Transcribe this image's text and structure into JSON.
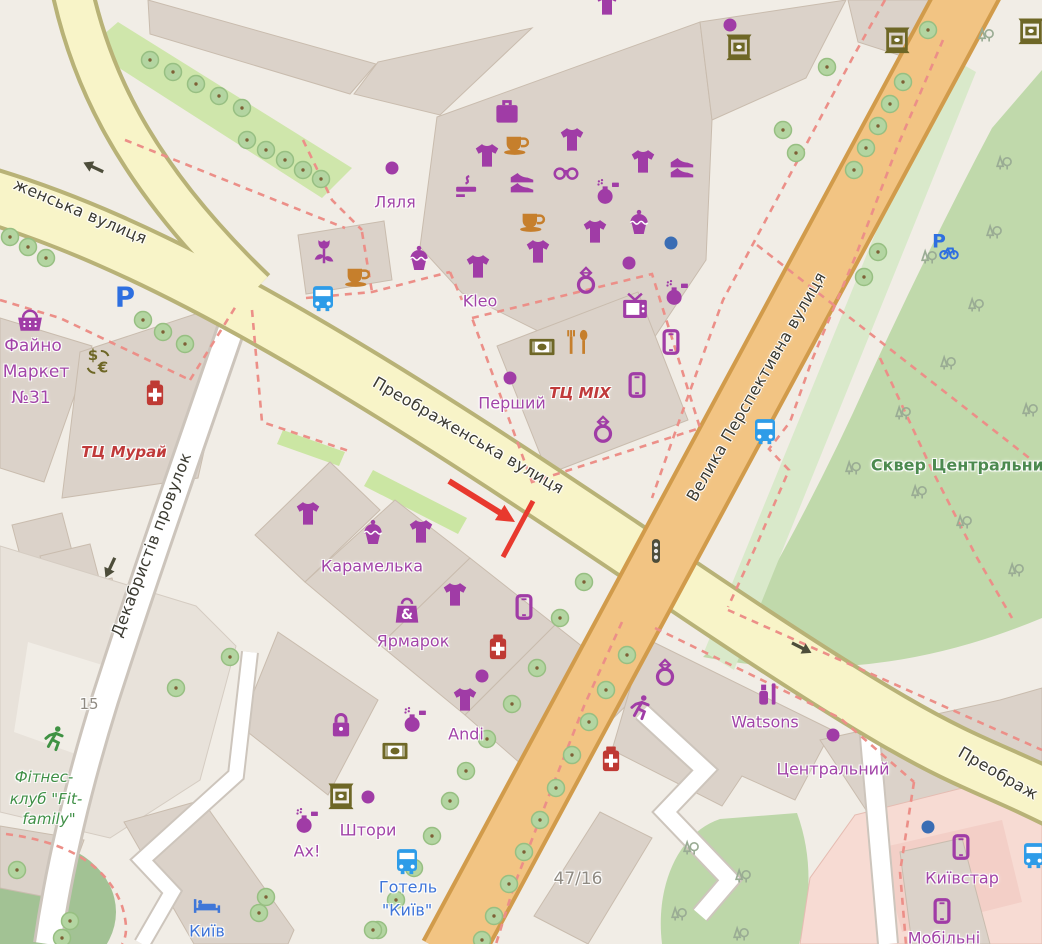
{
  "map": {
    "description": "OpenStreetMap style city map of Kropyvnytskyi area with red tutorial arrow annotation",
    "street_labels": [
      {
        "text": "женська вулиця",
        "x": 80,
        "y": 212,
        "rot": 23,
        "size": 16
      },
      {
        "text": "Преображенська вулиця",
        "x": 468,
        "y": 436,
        "rot": 30,
        "size": 16
      },
      {
        "text": "Велика Перспективна вулиця",
        "x": 757,
        "y": 387,
        "rot": -60,
        "size": 16
      },
      {
        "text": "Декабристів провулок",
        "x": 152,
        "y": 545,
        "rot": -69,
        "size": 16
      },
      {
        "text": "Преображ",
        "x": 998,
        "y": 774,
        "rot": 30,
        "size": 16
      }
    ],
    "place_labels": [
      {
        "text": "Ляля",
        "x": 395,
        "y": 203,
        "cls": "poi",
        "size": 16
      },
      {
        "text": "Kleo",
        "x": 480,
        "y": 302,
        "cls": "poi",
        "size": 16
      },
      {
        "text": "Перший",
        "x": 512,
        "y": 404,
        "cls": "poi",
        "size": 16
      },
      {
        "text": "ТЦ MIX",
        "x": 580,
        "y": 394,
        "cls": "mall",
        "size": 15
      },
      {
        "text": "Файно",
        "x": 33,
        "y": 347,
        "cls": "poi",
        "size": 17
      },
      {
        "text": "Маркет",
        "x": 36,
        "y": 373,
        "cls": "poi",
        "size": 17
      },
      {
        "text": "№31",
        "x": 31,
        "y": 399,
        "cls": "poi",
        "size": 17
      },
      {
        "text": "ТЦ Мурай",
        "x": 124,
        "y": 453,
        "cls": "mall",
        "size": 15
      },
      {
        "text": "Карамелька",
        "x": 372,
        "y": 567,
        "cls": "poi",
        "size": 16
      },
      {
        "text": "Ярмарок",
        "x": 413,
        "y": 642,
        "cls": "poi",
        "size": 16
      },
      {
        "text": "Andi",
        "x": 466,
        "y": 735,
        "cls": "poi",
        "size": 16
      },
      {
        "text": "Штори",
        "x": 368,
        "y": 831,
        "cls": "poi",
        "size": 16
      },
      {
        "text": "Ах!",
        "x": 307,
        "y": 852,
        "cls": "poi",
        "size": 16
      },
      {
        "text": "Watsons",
        "x": 765,
        "y": 723,
        "cls": "poi",
        "size": 16
      },
      {
        "text": "Центральний",
        "x": 833,
        "y": 770,
        "cls": "poi",
        "size": 16
      },
      {
        "text": "Київстар",
        "x": 962,
        "y": 879,
        "cls": "poi",
        "size": 16
      },
      {
        "text": "Мобільні",
        "x": 944,
        "y": 939,
        "cls": "poi",
        "size": 16
      },
      {
        "text": "Готель",
        "x": 408,
        "y": 888,
        "cls": "hotel",
        "size": 16
      },
      {
        "text": "\"Київ\"",
        "x": 407,
        "y": 911,
        "cls": "hotel",
        "size": 16
      },
      {
        "text": "Київ",
        "x": 207,
        "y": 932,
        "cls": "hotel",
        "size": 16
      },
      {
        "text": "Сквер Центральний",
        "x": 963,
        "y": 466,
        "cls": "park",
        "size": 16
      },
      {
        "text": "Фітнес-",
        "x": 44,
        "y": 778,
        "cls": "fitness",
        "size": 15
      },
      {
        "text": "клуб \"Fit-",
        "x": 46,
        "y": 800,
        "cls": "fitness",
        "size": 15
      },
      {
        "text": "family\"",
        "x": 49,
        "y": 820,
        "cls": "fitness",
        "size": 15
      },
      {
        "text": "15",
        "x": 89,
        "y": 705,
        "cls": "housenum",
        "size": 15
      },
      {
        "text": "47/16",
        "x": 578,
        "y": 880,
        "cls": "housenum",
        "size": 17
      }
    ],
    "label_colors": {
      "street": "#3b3a31",
      "poi": "#a244a8",
      "mall": "#c03a3a",
      "hotel": "#3f75d9",
      "park": "#4c8a4f",
      "fitness": "#3f8f46",
      "housenum": "#8f8a82"
    },
    "palette": {
      "purple": "#a03ca6",
      "orange": "#c67f2c",
      "olive": "#6e6726",
      "red": "#bf3a34",
      "blue": "#2e9ce8",
      "parkblue": "#2e6fe0",
      "hotelblue": "#4077d8",
      "green": "#3f9243",
      "dark": "#4d4d3a",
      "dotblue": "#3a6db4"
    },
    "pois": [
      {
        "icon": "suitcase",
        "x": 507,
        "y": 112,
        "c": "purple"
      },
      {
        "icon": "coffee",
        "x": 516,
        "y": 143,
        "c": "orange"
      },
      {
        "icon": "tshirt",
        "x": 487,
        "y": 156,
        "c": "purple"
      },
      {
        "icon": "tshirt",
        "x": 572,
        "y": 140,
        "c": "purple"
      },
      {
        "icon": "glasses",
        "x": 566,
        "y": 173,
        "c": "purple"
      },
      {
        "icon": "shoes",
        "x": 522,
        "y": 183,
        "c": "purple"
      },
      {
        "icon": "cigarette",
        "x": 468,
        "y": 188,
        "c": "purple"
      },
      {
        "icon": "tshirt",
        "x": 643,
        "y": 162,
        "c": "purple"
      },
      {
        "icon": "shoes",
        "x": 682,
        "y": 168,
        "c": "purple"
      },
      {
        "icon": "perfume",
        "x": 607,
        "y": 192,
        "c": "purple"
      },
      {
        "icon": "cupcake",
        "x": 639,
        "y": 224,
        "c": "purple"
      },
      {
        "icon": "tshirt",
        "x": 595,
        "y": 232,
        "c": "purple"
      },
      {
        "icon": "coffee",
        "x": 532,
        "y": 220,
        "c": "orange"
      },
      {
        "icon": "tshirt",
        "x": 538,
        "y": 252,
        "c": "purple"
      },
      {
        "icon": "dot",
        "x": 671,
        "y": 243,
        "c": "dotblue"
      },
      {
        "icon": "dot",
        "x": 629,
        "y": 263,
        "c": "purple"
      },
      {
        "icon": "ring",
        "x": 586,
        "y": 281,
        "c": "purple"
      },
      {
        "icon": "tshirt",
        "x": 478,
        "y": 267,
        "c": "purple"
      },
      {
        "icon": "cupcake",
        "x": 419,
        "y": 260,
        "c": "purple"
      },
      {
        "icon": "perfume",
        "x": 676,
        "y": 293,
        "c": "purple"
      },
      {
        "icon": "tv",
        "x": 635,
        "y": 308,
        "c": "purple"
      },
      {
        "icon": "phone",
        "x": 671,
        "y": 342,
        "c": "purple"
      },
      {
        "icon": "banknote",
        "x": 542,
        "y": 347,
        "c": "olive"
      },
      {
        "icon": "forkspoon",
        "x": 578,
        "y": 342,
        "c": "orange"
      },
      {
        "icon": "dot",
        "x": 510,
        "y": 378,
        "c": "purple"
      },
      {
        "icon": "phone",
        "x": 637,
        "y": 385,
        "c": "purple"
      },
      {
        "icon": "ring",
        "x": 603,
        "y": 430,
        "c": "purple"
      },
      {
        "icon": "tshirt",
        "x": 607,
        "y": 4,
        "c": "purple"
      },
      {
        "icon": "dot",
        "x": 730,
        "y": 25,
        "c": "purple"
      },
      {
        "icon": "atm",
        "x": 739,
        "y": 47,
        "c": "olive"
      },
      {
        "icon": "atm",
        "x": 897,
        "y": 40,
        "c": "olive"
      },
      {
        "icon": "atm",
        "x": 1031,
        "y": 31,
        "c": "olive"
      },
      {
        "icon": "tulip",
        "x": 324,
        "y": 252,
        "c": "purple"
      },
      {
        "icon": "coffee",
        "x": 357,
        "y": 275,
        "c": "orange"
      },
      {
        "icon": "bus",
        "x": 323,
        "y": 298,
        "c": "blue"
      },
      {
        "icon": "parking",
        "x": 125,
        "y": 297,
        "c": "parkblue"
      },
      {
        "icon": "basket",
        "x": 30,
        "y": 322,
        "c": "purple"
      },
      {
        "icon": "currency",
        "x": 99,
        "y": 361,
        "c": "olive"
      },
      {
        "icon": "pharmacy",
        "x": 155,
        "y": 393,
        "c": "red"
      },
      {
        "icon": "dot",
        "x": 392,
        "y": 168,
        "c": "purple"
      },
      {
        "icon": "bikeparking",
        "x": 944,
        "y": 246,
        "c": "parkblue"
      },
      {
        "icon": "bus",
        "x": 765,
        "y": 431,
        "c": "blue"
      },
      {
        "icon": "trafficsignal",
        "x": 656,
        "y": 551,
        "c": "dark"
      },
      {
        "icon": "oneway",
        "x": 93,
        "y": 167,
        "rot": 205,
        "c": "dark"
      },
      {
        "icon": "oneway",
        "x": 110,
        "y": 568,
        "rot": 115,
        "c": "dark"
      },
      {
        "icon": "oneway",
        "x": 802,
        "y": 648,
        "rot": 27,
        "c": "dark"
      },
      {
        "icon": "tshirt",
        "x": 308,
        "y": 514,
        "c": "purple"
      },
      {
        "icon": "cupcake",
        "x": 373,
        "y": 534,
        "c": "purple"
      },
      {
        "icon": "tshirt",
        "x": 421,
        "y": 532,
        "c": "purple"
      },
      {
        "icon": "tshirt",
        "x": 455,
        "y": 595,
        "c": "purple"
      },
      {
        "icon": "bag",
        "x": 407,
        "y": 612,
        "c": "purple"
      },
      {
        "icon": "phone",
        "x": 524,
        "y": 607,
        "c": "purple"
      },
      {
        "icon": "pharmacy",
        "x": 498,
        "y": 647,
        "c": "red"
      },
      {
        "icon": "dot",
        "x": 482,
        "y": 676,
        "c": "purple"
      },
      {
        "icon": "tshirt",
        "x": 465,
        "y": 700,
        "c": "purple"
      },
      {
        "icon": "perfume",
        "x": 414,
        "y": 720,
        "c": "purple"
      },
      {
        "icon": "padlock",
        "x": 341,
        "y": 727,
        "c": "purple"
      },
      {
        "icon": "banknote",
        "x": 395,
        "y": 751,
        "c": "olive"
      },
      {
        "icon": "atm",
        "x": 341,
        "y": 796,
        "c": "olive"
      },
      {
        "icon": "dot",
        "x": 368,
        "y": 797,
        "c": "purple"
      },
      {
        "icon": "perfume",
        "x": 306,
        "y": 821,
        "c": "purple"
      },
      {
        "icon": "bus",
        "x": 407,
        "y": 861,
        "c": "blue"
      },
      {
        "icon": "bed",
        "x": 207,
        "y": 906,
        "c": "hotelblue"
      },
      {
        "icon": "ring",
        "x": 665,
        "y": 673,
        "c": "purple"
      },
      {
        "icon": "runner",
        "x": 640,
        "y": 708,
        "c": "purple"
      },
      {
        "icon": "cosmetics",
        "x": 768,
        "y": 694,
        "c": "purple"
      },
      {
        "icon": "pharmacy",
        "x": 611,
        "y": 759,
        "c": "red"
      },
      {
        "icon": "dot",
        "x": 833,
        "y": 735,
        "c": "purple"
      },
      {
        "icon": "phone",
        "x": 961,
        "y": 847,
        "c": "purple"
      },
      {
        "icon": "phone",
        "x": 942,
        "y": 911,
        "c": "purple"
      },
      {
        "icon": "dot",
        "x": 928,
        "y": 827,
        "c": "dotblue"
      },
      {
        "icon": "bus",
        "x": 1034,
        "y": 855,
        "c": "blue"
      },
      {
        "icon": "runner",
        "x": 54,
        "y": 739,
        "c": "green"
      }
    ],
    "trees": [
      [
        10,
        237
      ],
      [
        28,
        247
      ],
      [
        46,
        258
      ],
      [
        143,
        320
      ],
      [
        163,
        332
      ],
      [
        185,
        344
      ],
      [
        150,
        60
      ],
      [
        173,
        72
      ],
      [
        196,
        84
      ],
      [
        219,
        96
      ],
      [
        242,
        108
      ],
      [
        247,
        140
      ],
      [
        266,
        150
      ],
      [
        285,
        160
      ],
      [
        303,
        170
      ],
      [
        321,
        179
      ],
      [
        827,
        67
      ],
      [
        783,
        130
      ],
      [
        796,
        153
      ],
      [
        928,
        30
      ],
      [
        903,
        82
      ],
      [
        890,
        104
      ],
      [
        878,
        126
      ],
      [
        866,
        148
      ],
      [
        854,
        170
      ],
      [
        878,
        252
      ],
      [
        864,
        277
      ],
      [
        584,
        582
      ],
      [
        560,
        618
      ],
      [
        537,
        668
      ],
      [
        512,
        704
      ],
      [
        487,
        739
      ],
      [
        466,
        771
      ],
      [
        450,
        801
      ],
      [
        432,
        836
      ],
      [
        414,
        868
      ],
      [
        396,
        900
      ],
      [
        378,
        930
      ],
      [
        627,
        655
      ],
      [
        606,
        690
      ],
      [
        589,
        722
      ],
      [
        572,
        755
      ],
      [
        556,
        788
      ],
      [
        540,
        820
      ],
      [
        524,
        852
      ],
      [
        509,
        884
      ],
      [
        494,
        916
      ],
      [
        482,
        940
      ],
      [
        176,
        688
      ],
      [
        230,
        657
      ],
      [
        266,
        897
      ],
      [
        259,
        913
      ],
      [
        373,
        930
      ],
      [
        17,
        870
      ],
      [
        70,
        921
      ],
      [
        62,
        938
      ]
    ],
    "park_tree_glyphs": [
      [
        985,
        35
      ],
      [
        1003,
        163
      ],
      [
        993,
        232
      ],
      [
        928,
        257
      ],
      [
        975,
        305
      ],
      [
        947,
        363
      ],
      [
        902,
        413
      ],
      [
        1029,
        410
      ],
      [
        852,
        468
      ],
      [
        918,
        492
      ],
      [
        963,
        522
      ],
      [
        1015,
        570
      ],
      [
        690,
        848
      ],
      [
        742,
        876
      ],
      [
        678,
        914
      ],
      [
        740,
        934
      ]
    ],
    "annotation": {
      "color": "#e8392e",
      "arrow": {
        "from": [
          449,
          481
        ],
        "to": [
          515,
          522
        ]
      },
      "line": {
        "from": [
          533,
          501
        ],
        "to": [
          503,
          557
        ]
      }
    }
  }
}
